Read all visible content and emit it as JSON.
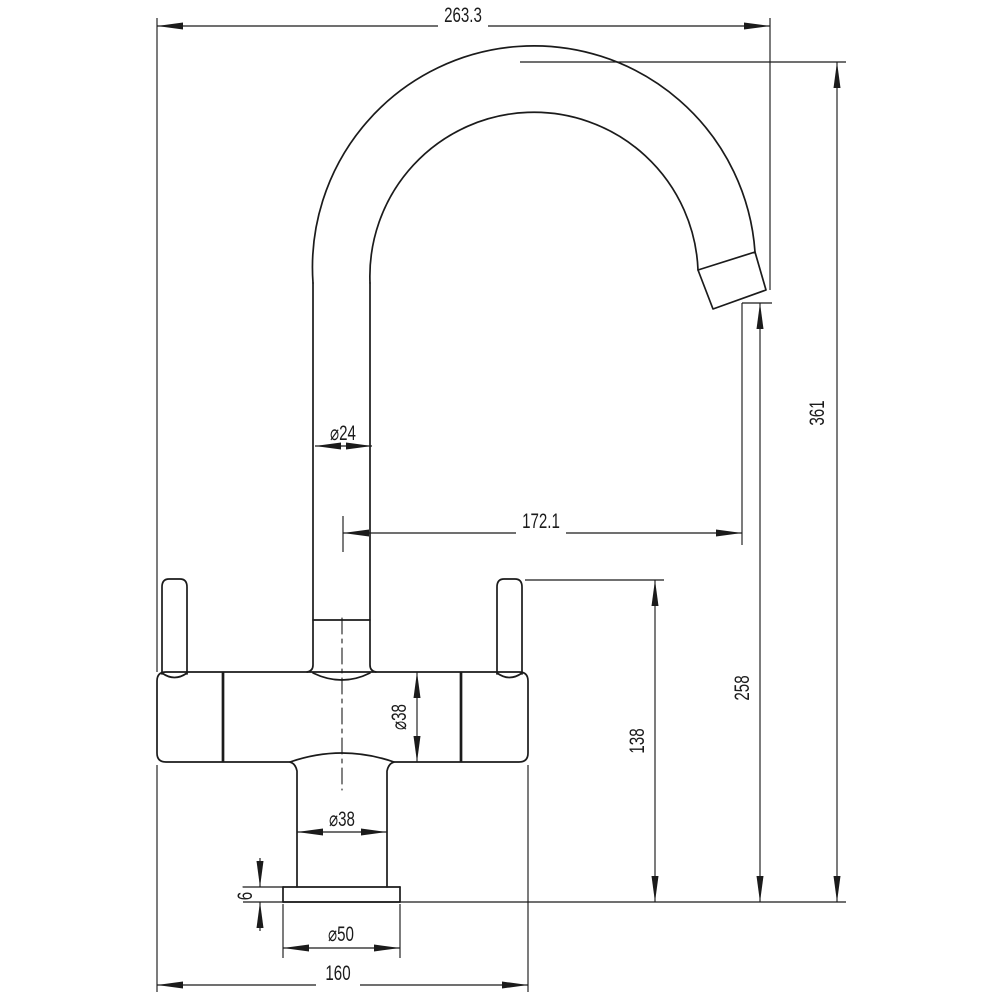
{
  "drawing": {
    "subject": "mixer-tap-side-elevation",
    "dimensions": {
      "overall_width": "263.3",
      "overall_height": "361",
      "spout_tube_diameter": "⌀24",
      "spout_horizontal_reach": "172.1",
      "spout_outlet_height": "258",
      "body_top_height": "138",
      "body_diameter": "⌀38",
      "base_column_diameter": "⌀38",
      "base_plate_diameter": "⌀50",
      "base_plate_thickness": "6",
      "overall_base_width": "160"
    },
    "colors": {
      "line": "#1b1b1b",
      "background": "#ffffff"
    }
  }
}
